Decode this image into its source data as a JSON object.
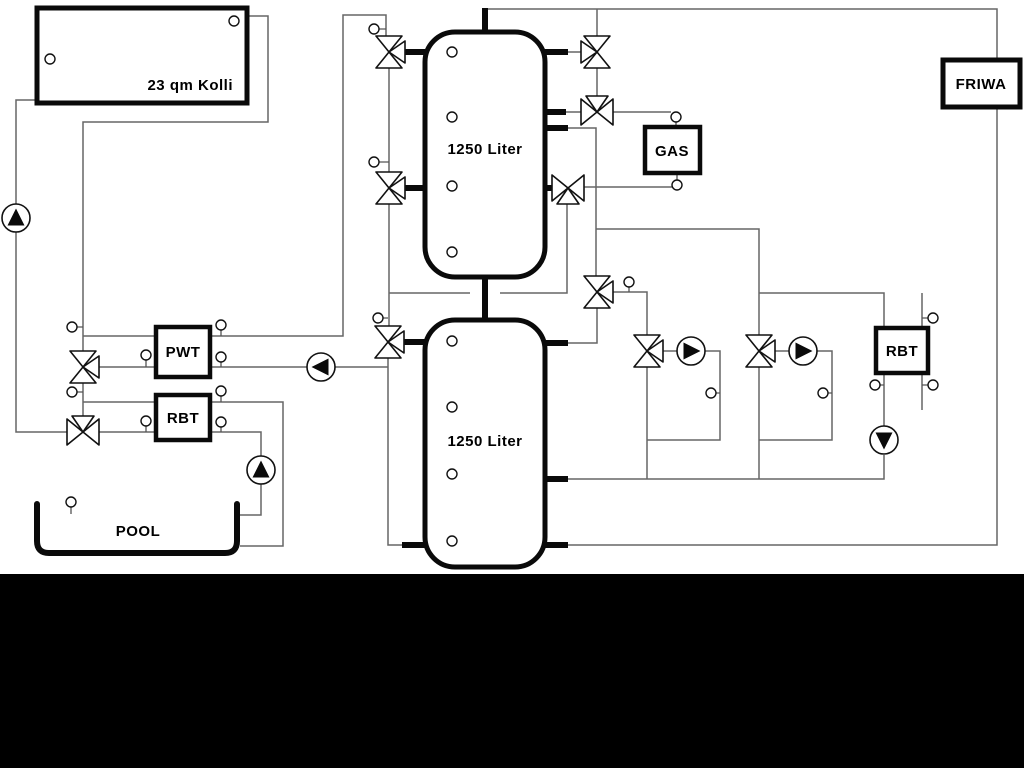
{
  "diagram": {
    "labels": {
      "collector": "23 qm Kolli",
      "tank_top": "1250 Liter",
      "tank_bottom": "1250 Liter",
      "gas": "GAS",
      "friwa": "FRIWA",
      "pwt": "PWT",
      "rbt_left": "RBT",
      "rbt_right": "RBT",
      "pool": "POOL"
    },
    "colors": {
      "background": "#ffffff",
      "pipe": "#666666",
      "symbol": "#111111",
      "bottom_bar": "#000000"
    }
  }
}
